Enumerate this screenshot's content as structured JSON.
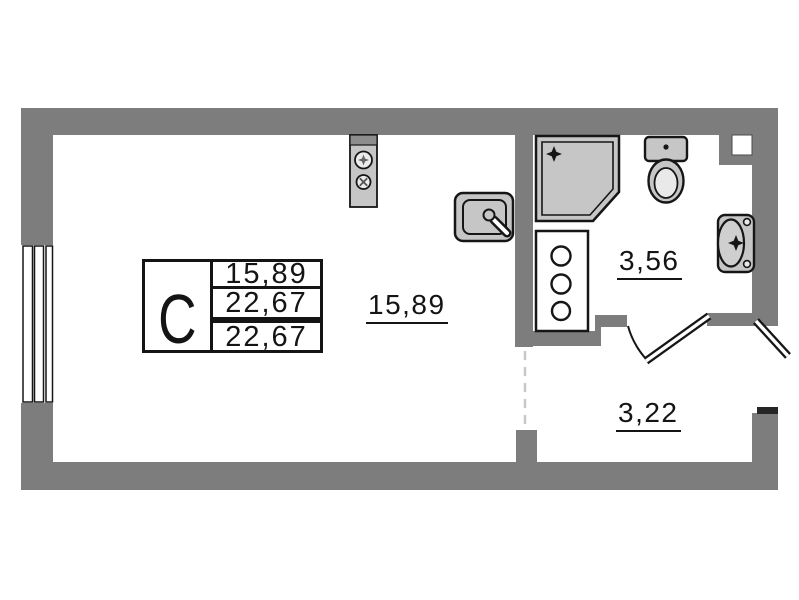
{
  "title": "Studio apartment floor plan",
  "colors": {
    "paper": "#ffffff",
    "wall": "#7d7d7d",
    "wallDark": "#262626",
    "fixture": "#c6c6c6",
    "fixtureLight": "#ececec",
    "outline": "#161616",
    "dashed": "#c8c8c8",
    "text": "#141414"
  },
  "unit_card": {
    "type_label": "C",
    "rows": [
      "15,89",
      "22,67",
      "22,67"
    ]
  },
  "rooms": [
    {
      "name": "living-room",
      "area": "15,89"
    },
    {
      "name": "bathroom",
      "area": "3,56"
    },
    {
      "name": "hallway",
      "area": "3,22"
    }
  ],
  "fixtures": [
    "window",
    "stove-icon",
    "kitchen-sink-icon",
    "shower-cabin-icon",
    "utility-cabinet-icon",
    "toilet-icon",
    "washbasin-icon",
    "vent-shaft",
    "bathroom-door",
    "entrance-door"
  ]
}
